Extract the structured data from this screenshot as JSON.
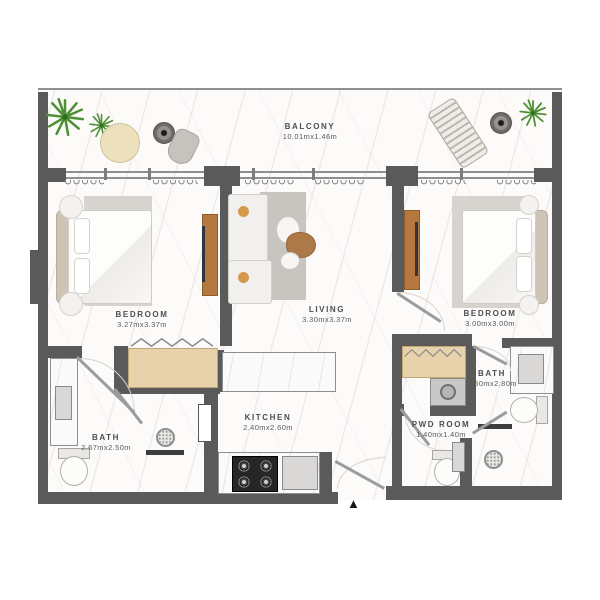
{
  "plan": {
    "entrance_marker": "▲",
    "rooms": [
      {
        "id": "balcony",
        "name": "BALCONY",
        "dims": "10.01mx1.46m"
      },
      {
        "id": "bedroom-left",
        "name": "BEDROOM",
        "dims": "3.27mx3.37m"
      },
      {
        "id": "living",
        "name": "LIVING",
        "dims": "3.30mx3.37m"
      },
      {
        "id": "bedroom-right",
        "name": "BEDROOM",
        "dims": "3.00mx3.00m"
      },
      {
        "id": "kitchen",
        "name": "KITCHEN",
        "dims": "2.40mx2.60m"
      },
      {
        "id": "bath-left",
        "name": "BATH",
        "dims": "2.67mx2.50m"
      },
      {
        "id": "bath-right",
        "name": "BATH",
        "dims": "1.50mx2.80m"
      },
      {
        "id": "pwd-room",
        "name": "PWD ROOM",
        "dims": "1.40mx1.40m"
      }
    ],
    "colors": {
      "wall": "#5a5a5a",
      "wood_console": "#b5793f",
      "wardrobe": "#e7d2ab",
      "plant": "#4e9134",
      "floor": "#fcfbfa"
    }
  }
}
